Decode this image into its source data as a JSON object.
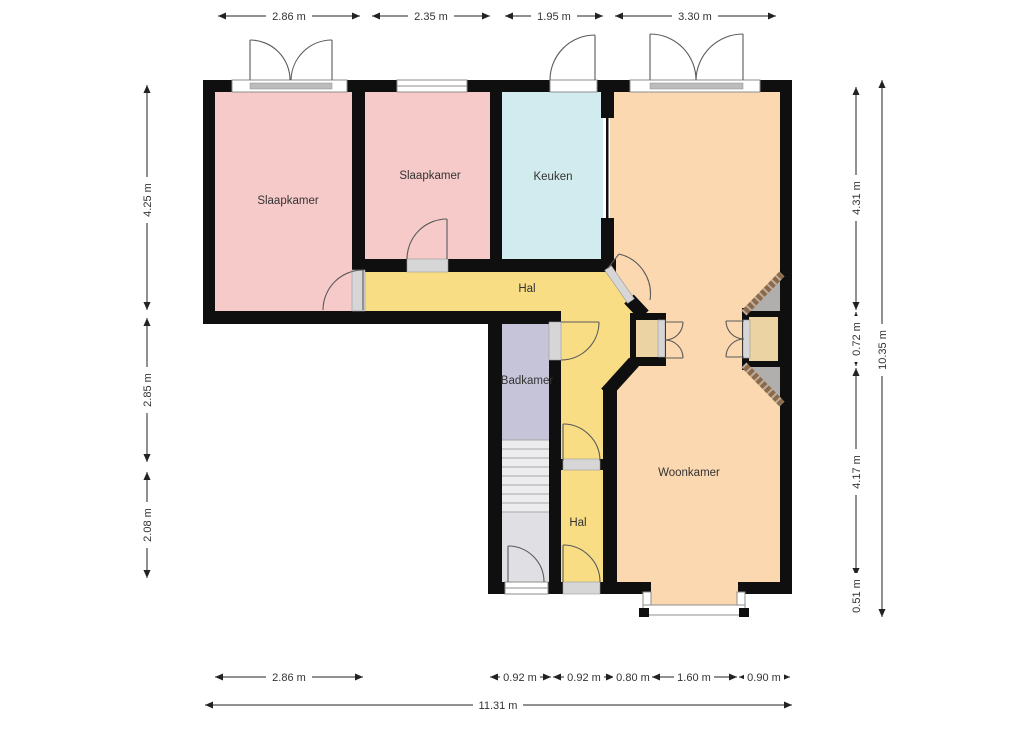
{
  "plan_title": "Floor plan",
  "rooms": {
    "slaapkamer1": "Slaapkamer",
    "slaapkamer2": "Slaapkamer",
    "keuken": "Keuken",
    "hal_top": "Hal",
    "badkamer": "Badkamer",
    "hal_bottom": "Hal",
    "woonkamer": "Woonkamer"
  },
  "dimensions": {
    "top": [
      "2.86 m",
      "2.35 m",
      "1.95 m",
      "3.30 m"
    ],
    "left": [
      "4.25 m",
      "2.85 m",
      "2.08 m"
    ],
    "right": [
      "4.31 m",
      "0.72 m",
      "4.17 m",
      "0.51 m"
    ],
    "right_total": "10.35 m",
    "bottom": [
      "2.86 m",
      "0.92 m",
      "0.92 m",
      "0.80 m",
      "1.60 m",
      "0.90 m"
    ],
    "bottom_total": "11.31 m"
  },
  "colors": {
    "wall": "#0f0f0f",
    "bedroom": "#f7caca",
    "kitchen": "#d2ebee",
    "living": "#fbd8b0",
    "hall": "#f8dd85",
    "bathroom": "#c5c4d9",
    "closet": "#ecd3a4",
    "stairs": "#ececef",
    "vestibule": "#e0e0e4",
    "chimney_brick": "#8a6a4a",
    "chimney_side": "#b0afae",
    "dimension_text": "#333333",
    "background": "#ffffff"
  }
}
